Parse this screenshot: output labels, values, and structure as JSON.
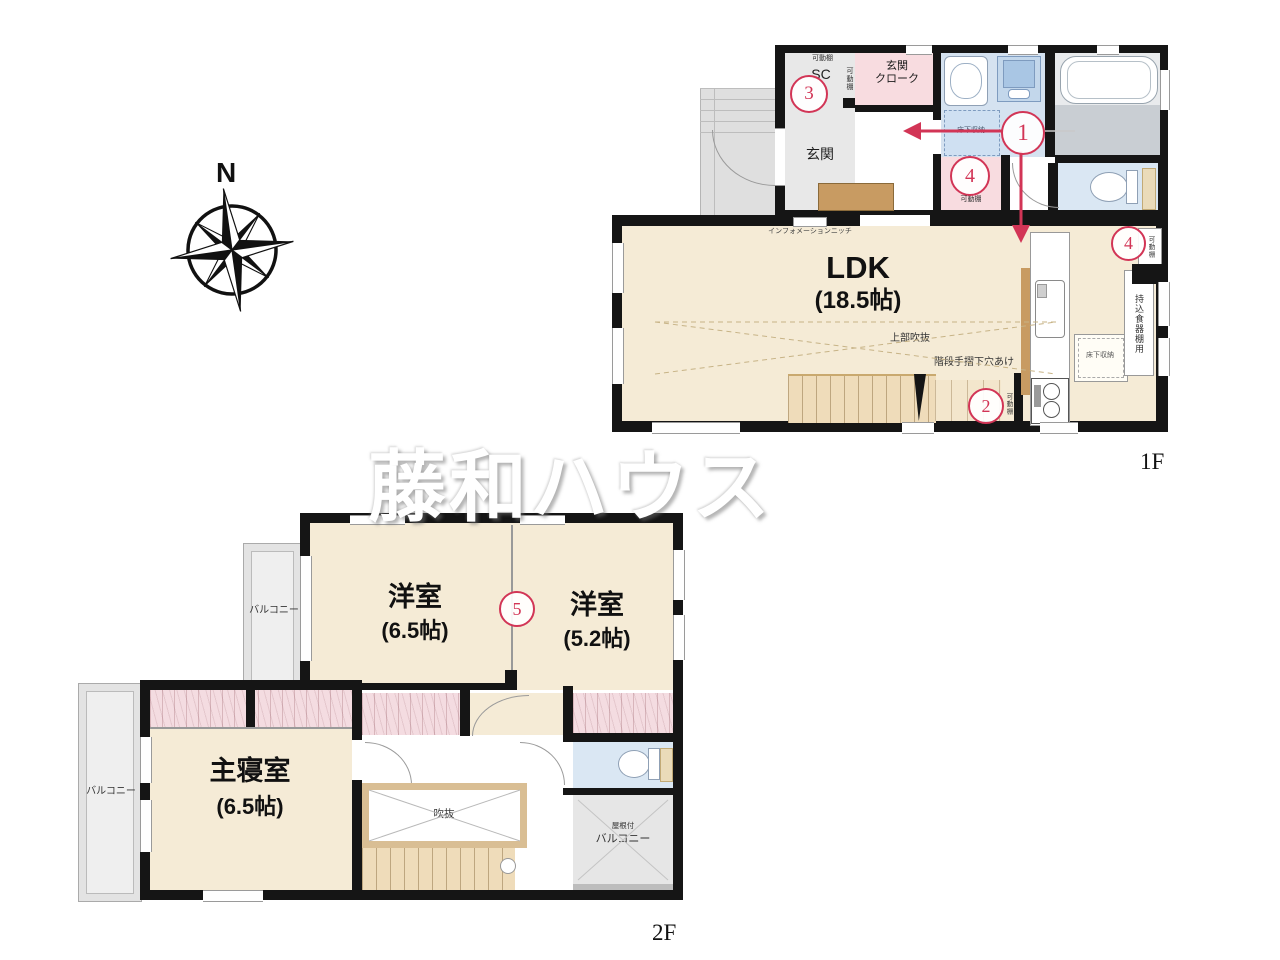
{
  "watermark": "藤和ハウス",
  "compass": {
    "north": "N"
  },
  "annotation_color": "#d23556",
  "floors": {
    "f1": {
      "label": "1F",
      "ldk_name": "LDK",
      "ldk_size": "(18.5帖)",
      "genkan": "玄関",
      "cloak_line1": "玄関",
      "cloak_line2": "クローク",
      "sc": "SC",
      "kadoudana": "可動棚",
      "yukashita": "床下収納",
      "info_niche": "インフォメーションニッチ",
      "joubu_fukinuke": "上部吹抜",
      "kaidan_note": "階段手摺下穴あけ",
      "mochikomi": "持込食器棚用"
    },
    "f2": {
      "label": "2F",
      "yoshitsu_a_name": "洋室",
      "yoshitsu_a_size": "(6.5帖)",
      "yoshitsu_b_name": "洋室",
      "yoshitsu_b_size": "(5.2帖)",
      "shinshitsu_name": "主寝室",
      "shinshitsu_size": "(6.5帖)",
      "balcony": "バルコニー",
      "fukinuke": "吹抜",
      "yanetsuki": "屋根付"
    }
  },
  "markers": {
    "m1": "1",
    "m2": "2",
    "m3": "3",
    "m4": "4",
    "m5": "5"
  }
}
